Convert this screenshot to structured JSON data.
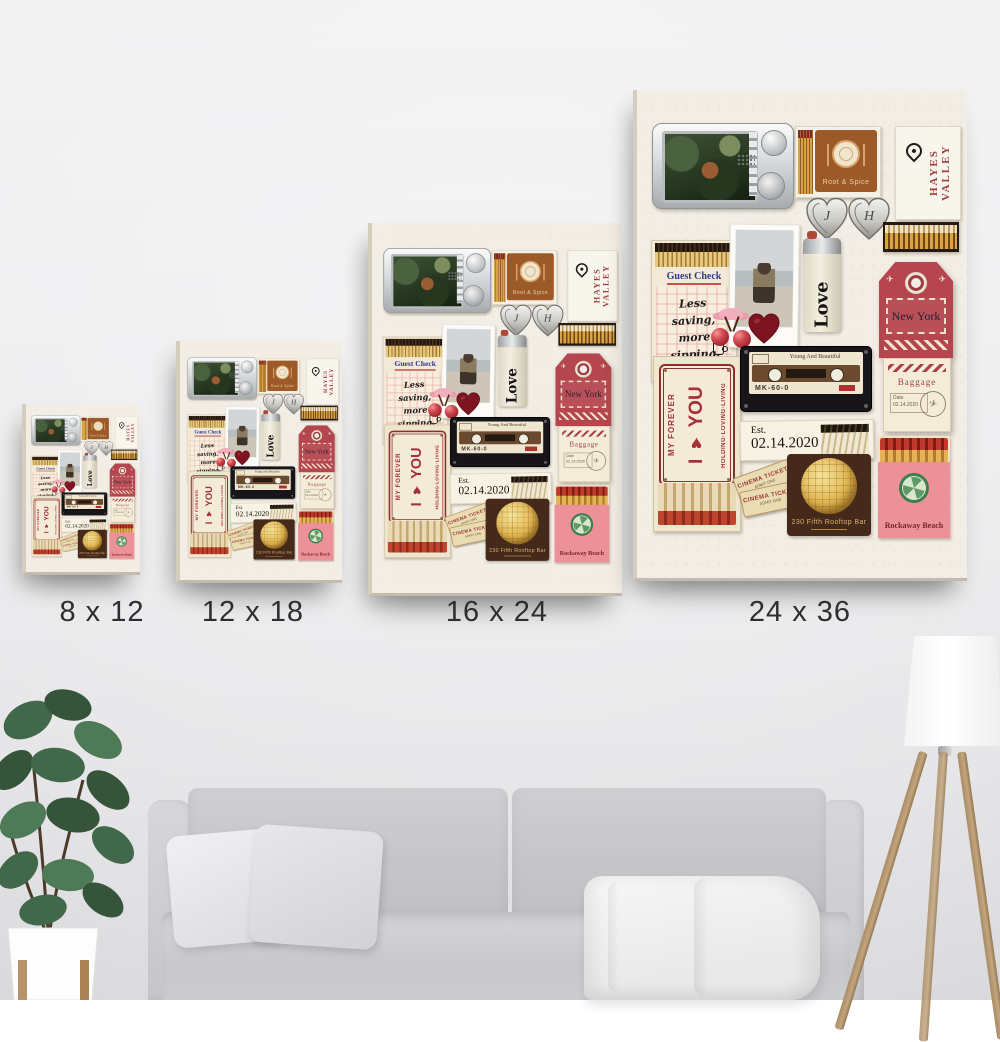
{
  "sizes": [
    {
      "label": "8 x 12"
    },
    {
      "label": "12 x 18"
    },
    {
      "label": "16 x 24"
    },
    {
      "label": "24 x 36"
    }
  ],
  "collage": {
    "root_spice": {
      "name": "Root & Spice"
    },
    "hayes_valley": {
      "text": "HAYES VALLEY"
    },
    "lockets": {
      "left_initial": "J",
      "right_initial": "H"
    },
    "guest_check": {
      "title": "Guest Check",
      "line1": "Less",
      "line2": "saving,",
      "line3": "more",
      "line4": "sipping."
    },
    "lighter": {
      "text": "Love"
    },
    "ny_tag": {
      "city": "New York",
      "baggage": "Baggage",
      "date_label": "Date",
      "date": "02.14.2020",
      "plane": "✈"
    },
    "forever_plate": {
      "left": "MY FOREVER",
      "center": "I ♥ YOU",
      "right": "HOLDING·LOVING·LIVING"
    },
    "cassette": {
      "title": "Young And Beautiful",
      "model": "MK-60-0",
      "logo": "TDK"
    },
    "est": {
      "prefix": "Est.",
      "date": "02.14.2020"
    },
    "cinema_ticket": {
      "line1": "CINEMA TICKET",
      "line2": "ADMIT ONE"
    },
    "rooftop": {
      "name": "230 Fifth Rooftop Bar"
    },
    "rockaway": {
      "name": "Rockaway Beach"
    }
  },
  "colors": {
    "wall": "#ececee",
    "canvas_background": "#f3eee5",
    "accent_red": "#b5454e",
    "accent_brown": "#9c5a28",
    "accent_pink": "#ec9197",
    "dark_red_heart": "#7e1420",
    "sofa_gray": "#c8c8cb"
  }
}
